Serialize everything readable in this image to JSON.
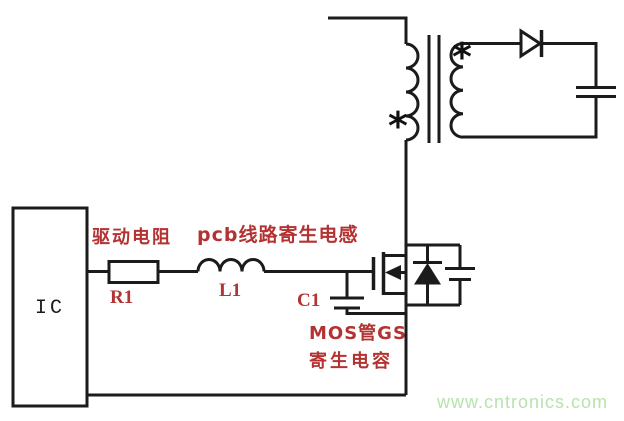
{
  "colors": {
    "background": "#ffffff",
    "line": "#1b1b1b",
    "label_red": "#b43232",
    "watermark_green": "#b7e3ad"
  },
  "circuit": {
    "ic_label": "IC",
    "drive_resistor_label": "驱动电阻",
    "r1_label": "R1",
    "pcb_inductance_label": "pcb线路寄生电感",
    "l1_label": "L1",
    "c1_label": "C1",
    "mos_gs_label_line1": "MOS管GS",
    "mos_gs_label_line2": "寄生电容",
    "primary_polarity_mark": "*",
    "secondary_polarity_mark": "*"
  },
  "watermark": {
    "text": "www.cntronics.com"
  }
}
